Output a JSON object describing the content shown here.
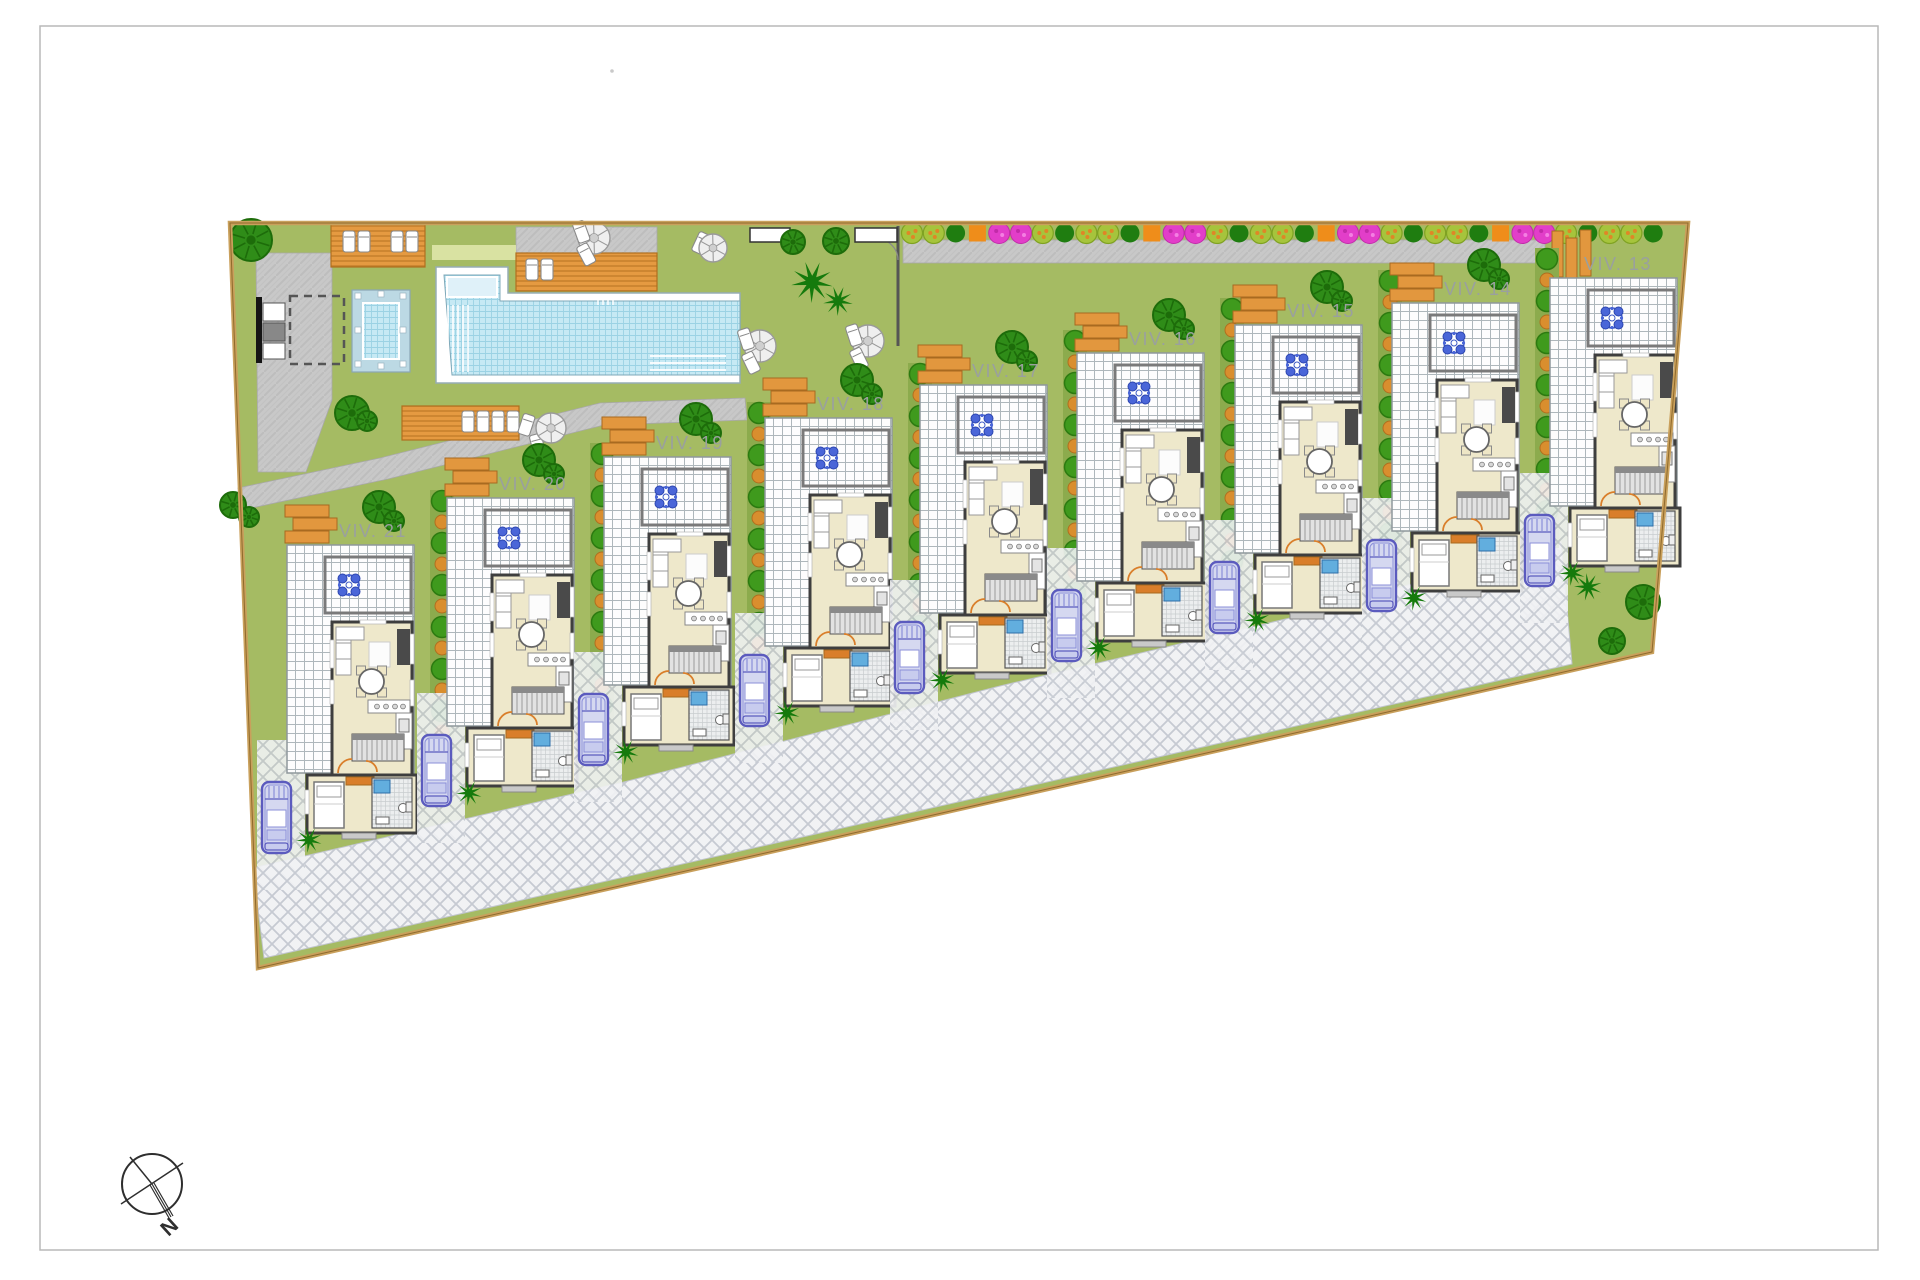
{
  "site": {
    "villas": [
      {
        "id": "viv-21",
        "label": "VIV. 21"
      },
      {
        "id": "viv-20",
        "label": "VIV. 20"
      },
      {
        "id": "viv-19",
        "label": "VIV. 19"
      },
      {
        "id": "viv-18",
        "label": "VIV. 18"
      },
      {
        "id": "viv-17",
        "label": "VIV. 17"
      },
      {
        "id": "viv-16",
        "label": "VIV. 16"
      },
      {
        "id": "viv-15",
        "label": "VIV. 15"
      },
      {
        "id": "viv-14",
        "label": "VIV. 14"
      },
      {
        "id": "viv-13",
        "label": "VIV. 13"
      }
    ],
    "flower_row_cycle": [
      "lime",
      "lime",
      "dark-green",
      "orange",
      "magenta",
      "magenta",
      "lime",
      "dark-green"
    ],
    "colors": {
      "lawn": "#a5bb63",
      "lawn_light": "#d9e2a2",
      "hedge_strip": "#8cab4d",
      "paving": "#c8c8c8",
      "herringbone_bg": "#f1f2f4",
      "herringbone_line": "#c6cad2",
      "deck_orange": "#e59a41",
      "planter_orange": "#e2973e",
      "pool_water": "#c6e9f4",
      "pool_platform": "#dff1f9",
      "spa_rim": "#bcd9e4",
      "house_fill": "#eee8cb",
      "house_wall": "#3e3e3e",
      "door_orange": "#d97e2a",
      "shower_blue": "#62aede",
      "car_stroke": "#5b5bbe",
      "car_fill": "#d5d8f0",
      "tree_green": "#2f8c18",
      "tree_dark": "#1d6c0a",
      "palm_green": "#157a0c",
      "bush_green": "#3f9a1d",
      "bush_orange_dot": "#d98e2e",
      "flower_magenta": "#e23ec9",
      "flower_orange": "#ef8d1a",
      "flower_lime": "#a6c43c",
      "boundary_tan": "#c9a05c",
      "label_gray": "#9aa09e",
      "ornament_blue": "#4a66d8"
    }
  },
  "compass": {
    "north_label": "N"
  }
}
